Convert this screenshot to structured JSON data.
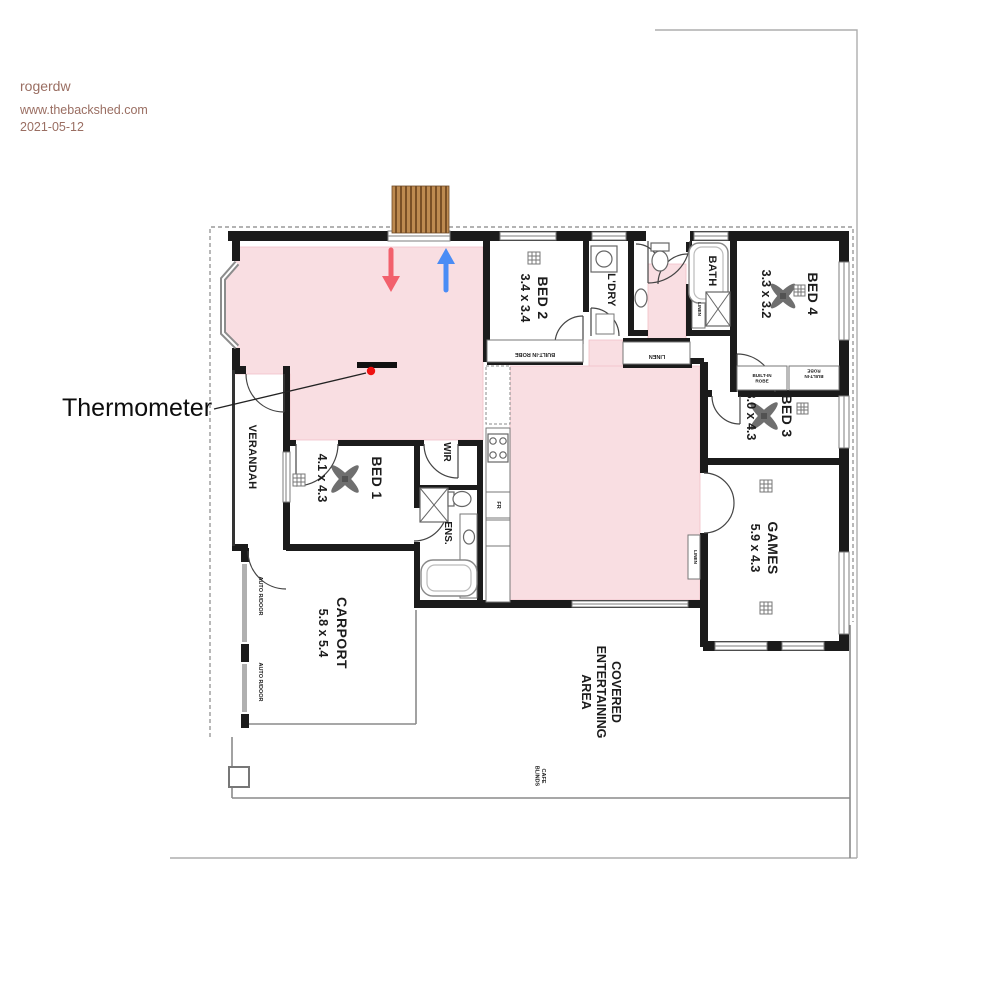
{
  "header": {
    "username": "rogerdw",
    "site": "www.thebackshed.com",
    "date": "2021-05-12"
  },
  "annotation": {
    "thermometer": "Thermometer"
  },
  "rooms": {
    "bed2": {
      "name": "BED 2",
      "dims": "3.4 x 3.4"
    },
    "ldry": {
      "name": "L'DRY"
    },
    "bath": {
      "name": "BATH"
    },
    "bed4": {
      "name": "BED 4",
      "dims": "3.3 x 3.2"
    },
    "bed3": {
      "name": "BED 3",
      "dims": "3.0 x 4.3"
    },
    "games": {
      "name": "GAMES",
      "dims": "5.9 x 4.3"
    },
    "bed1": {
      "name": "BED 1",
      "dims": "4.1 x 4.3"
    },
    "wir": {
      "name": "WIR"
    },
    "ens": {
      "name": "ENS."
    },
    "verandah": {
      "name": "VERANDAH"
    },
    "carport": {
      "name": "CARPORT",
      "dims": "5.8 x 5.4"
    },
    "covered": {
      "name": "COVERED ENTERTAINING AREA",
      "lines": [
        "COVERED",
        "ENTERTAINING",
        "AREA"
      ]
    }
  },
  "labels": {
    "robe_bed2": "BUILT-IN ROBE",
    "robe_b4": [
      "BUILT-IN",
      "ROBE"
    ],
    "robe_b3": [
      "BUILT-IN",
      "ROBE"
    ],
    "linen_hall": "LINEN",
    "linen_bath": "LINEN",
    "linen_family": "LINEN",
    "cafe": [
      "CAFE",
      "BLINDS"
    ],
    "auto_door": "AUTO R/DOOR",
    "fr": "FR"
  },
  "colors": {
    "highlight_pink": "#f9dee2",
    "arrow_red": "#f2606c",
    "arrow_blue": "#4a8cf5",
    "timber": "#bd8a50",
    "header_text": "#9a6e62",
    "dot_red": "#ee1111"
  }
}
